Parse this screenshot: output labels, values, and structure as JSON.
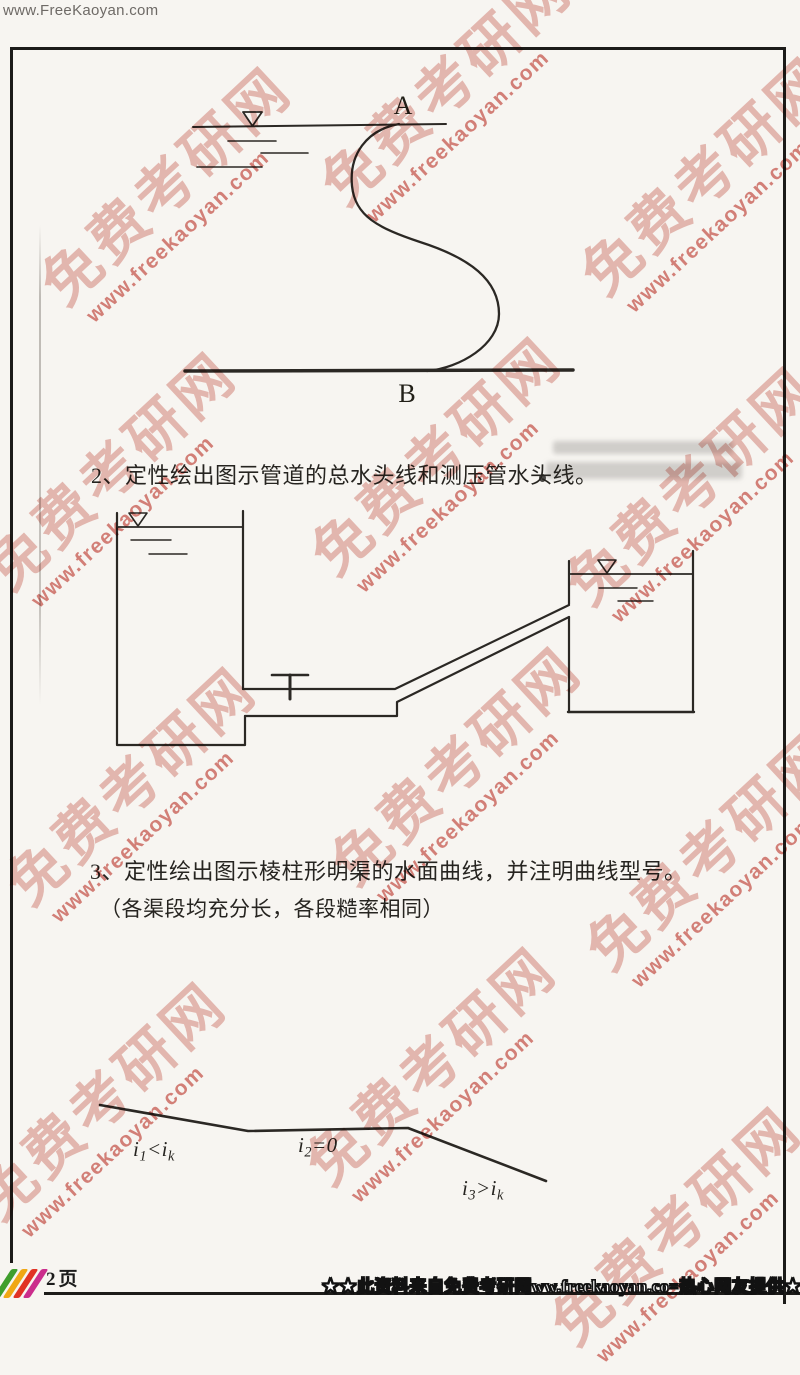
{
  "page": {
    "top_url": "www.FreeKaoyan.com",
    "page_label": "2页",
    "footer_banner": "★★此资料来自免费考研网ww.freekaoyan.co=热心网友提供★★"
  },
  "watermark": {
    "brand": "免费考研网",
    "url": "www.freekaoyan.com",
    "brand_color": "#d4776c",
    "url_color": "#c2392f"
  },
  "questions": {
    "q2": "2、定性绘出图示管道的总水头线和测压管水头线。",
    "q3": "3、定性绘出图示棱柱形明渠的水面曲线，并注明曲线型号。",
    "q3_note": "（各渠段均充分长，各段糙率相同）"
  },
  "figure_siphon": {
    "label_a": "A",
    "label_b": "B"
  },
  "figure_channel": {
    "slopes": [
      {
        "segments": [
          {
            "t": "i"
          },
          {
            "t": "1",
            "sub": true
          },
          {
            "t": "<"
          },
          {
            "t": "i"
          },
          {
            "t": "k",
            "sub": true
          }
        ]
      },
      {
        "segments": [
          {
            "t": "i"
          },
          {
            "t": "2",
            "sub": true
          },
          {
            "t": "=0"
          }
        ]
      },
      {
        "segments": [
          {
            "t": "i"
          },
          {
            "t": "3",
            "sub": true
          },
          {
            "t": ">"
          },
          {
            "t": "i"
          },
          {
            "t": "k",
            "sub": true
          }
        ]
      }
    ]
  },
  "logo_colors": [
    "#3f9e2d",
    "#f0a714",
    "#e13224",
    "#cb2d8c"
  ]
}
